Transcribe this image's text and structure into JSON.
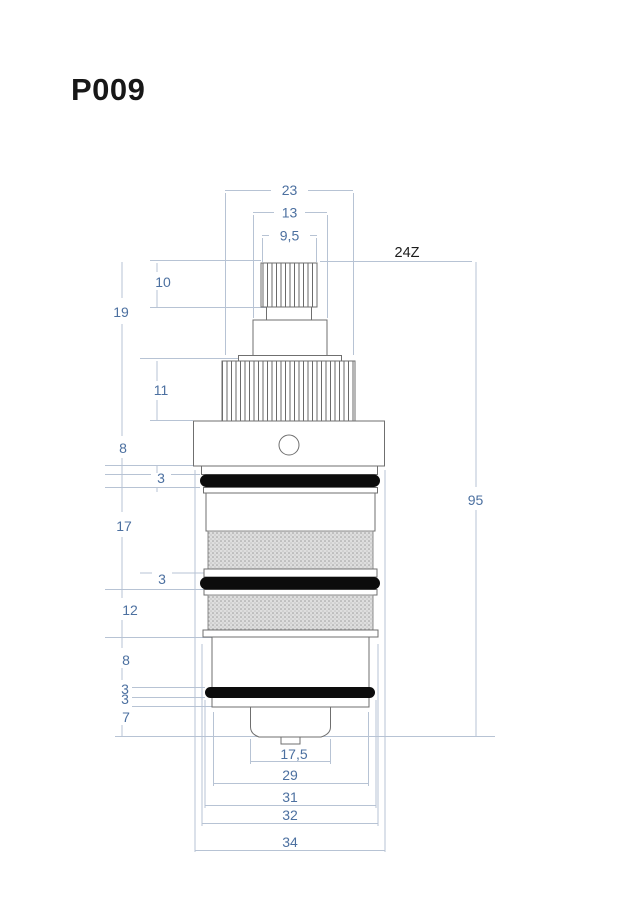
{
  "title": "P009",
  "drawing": {
    "spline_label": "24Z",
    "dims": {
      "top": [
        "23",
        "13",
        "9,5"
      ],
      "left": [
        "10",
        "19",
        "11",
        "8",
        "3",
        "17",
        "3",
        "12",
        "8",
        "3",
        "3",
        "7"
      ],
      "right": [
        "95"
      ],
      "bottom": [
        "17,5",
        "29",
        "31",
        "32",
        "34"
      ]
    }
  },
  "colors": {
    "outline": "#6f6f6f",
    "oring": "#0c0c0c",
    "dim_line": "#b7c3d4",
    "dim_text": "#4c70a0",
    "label_text": "#1c1c1c",
    "mesh_bg": "#dedede"
  }
}
